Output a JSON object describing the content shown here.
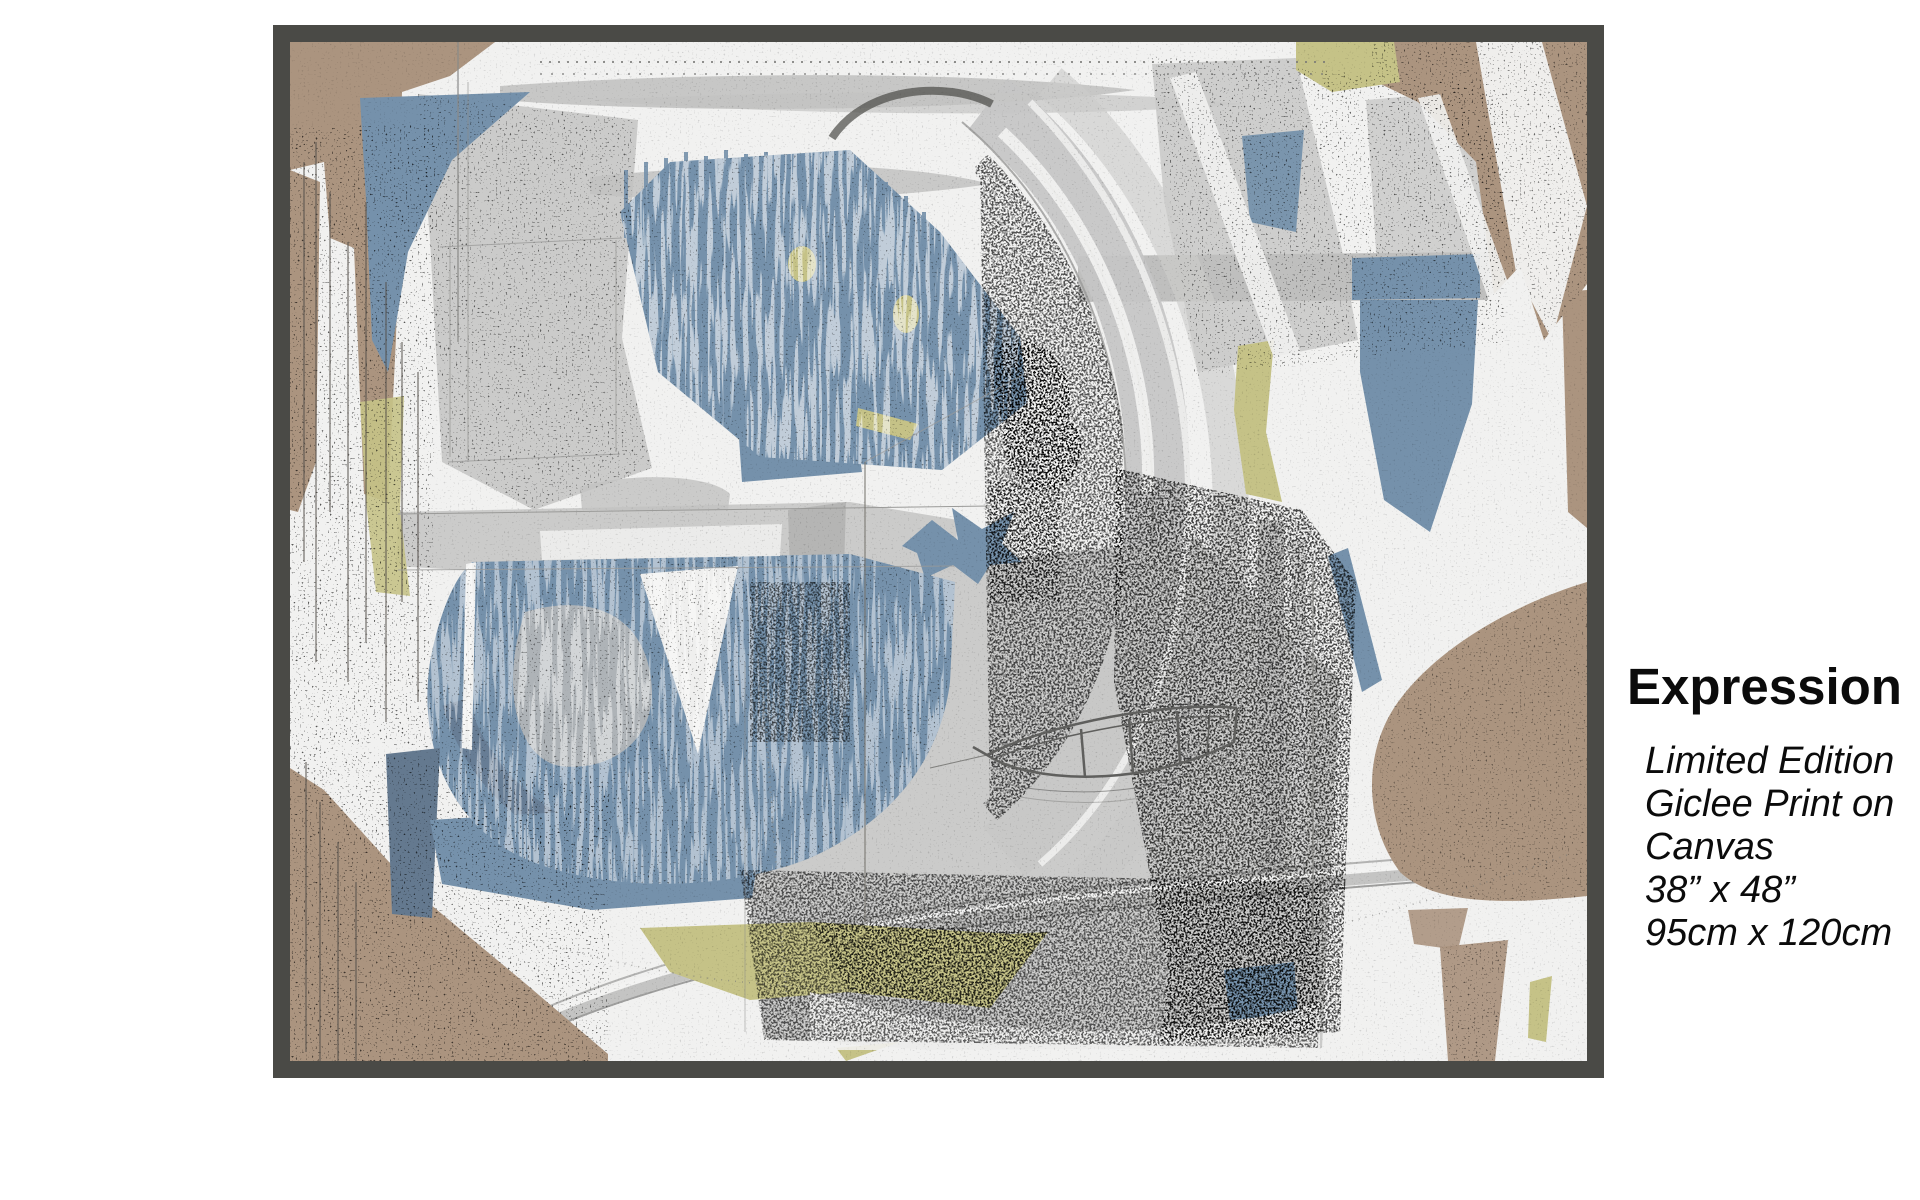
{
  "artwork": {
    "palette": {
      "frame": "#4a4a46",
      "canvas": "#f1f1f0",
      "tan": "#ab947f",
      "blue": "#7591ab",
      "bluedark": "#64798f",
      "olive": "#c5c287",
      "gray": "#c8c8c7",
      "ink": "#3a3a38"
    }
  },
  "caption": {
    "title": "Expression",
    "lines": [
      "Limited Edition",
      "Giclee Print on",
      "Canvas",
      "38” x 48”",
      "95cm x 120cm"
    ]
  }
}
